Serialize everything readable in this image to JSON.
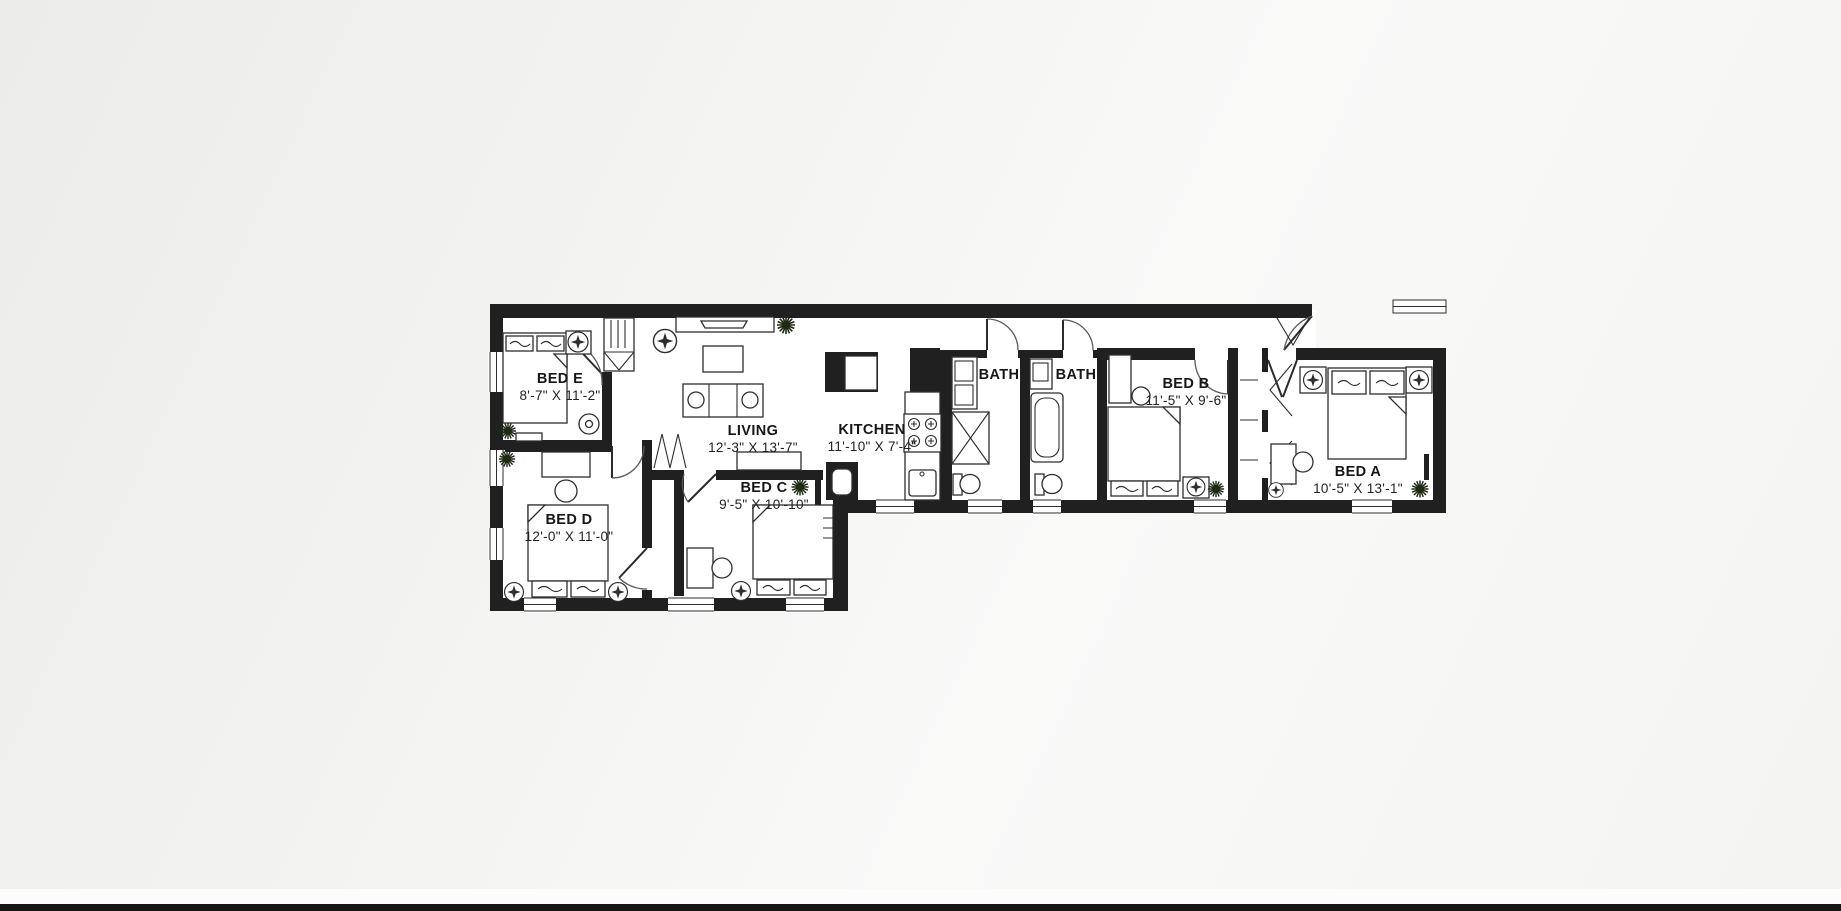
{
  "page": {
    "background_color": "#f2f2f0",
    "footer_strip_color": "#fcfcfb",
    "footer_bar_color": "#161616"
  },
  "floorplan": {
    "wall_color": "#202020",
    "floor_color": "#ffffff",
    "label_color": "#171717",
    "plant_color": "#1f2a14",
    "rooms": [
      {
        "id": "bed-e",
        "name": "BED E",
        "dims": "8'-7\" X 11'-2\""
      },
      {
        "id": "living",
        "name": "LIVING",
        "dims": "12'-3\" X 13'-7\""
      },
      {
        "id": "bed-d",
        "name": "BED D",
        "dims": "12'-0\" X 11'-0\""
      },
      {
        "id": "bed-c",
        "name": "BED C",
        "dims": "9'-5\" X 10'-10\""
      },
      {
        "id": "kitchen",
        "name": "KITCHEN",
        "dims": "11'-10\" X 7'-4\""
      },
      {
        "id": "bath-1",
        "name": "BATH",
        "dims": ""
      },
      {
        "id": "bath-2",
        "name": "BATH",
        "dims": ""
      },
      {
        "id": "bed-b",
        "name": "BED B",
        "dims": "11'-5\" X 9'-6\""
      },
      {
        "id": "bed-a",
        "name": "BED A",
        "dims": "10'-5\" X 13'-1\""
      }
    ]
  }
}
